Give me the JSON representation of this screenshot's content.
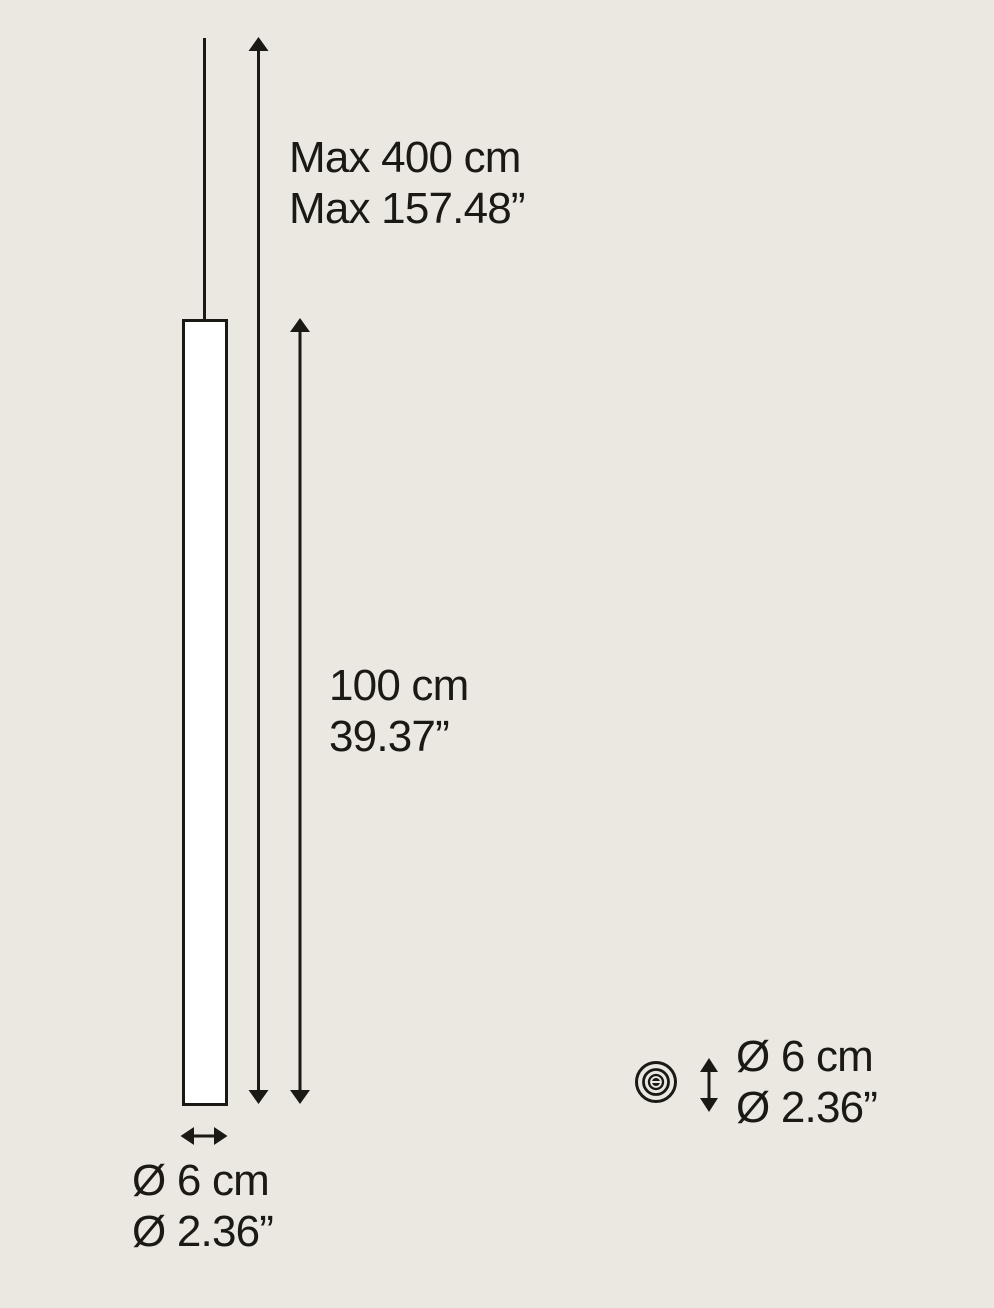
{
  "page": {
    "background_color": "#ebe8e2",
    "ink_color": "#1b1914",
    "tube_fill_color": "#ffffff"
  },
  "labels": {
    "max_suspension": {
      "line1": "Max 400 cm",
      "line2": "Max 157.48”"
    },
    "body_height": {
      "line1": "100 cm",
      "line2": "39.37”"
    },
    "body_diameter": {
      "line1": "Ø 6 cm",
      "line2": "Ø 2.36”"
    },
    "top_view_diameter": {
      "line1": "Ø 6 cm",
      "line2": "Ø 2.36”"
    }
  },
  "icons": {
    "top_view": "concentric-circles-icon",
    "vertical_dimension": "up-down-arrow-icon",
    "horizontal_dimension": "left-right-arrow-icon"
  }
}
